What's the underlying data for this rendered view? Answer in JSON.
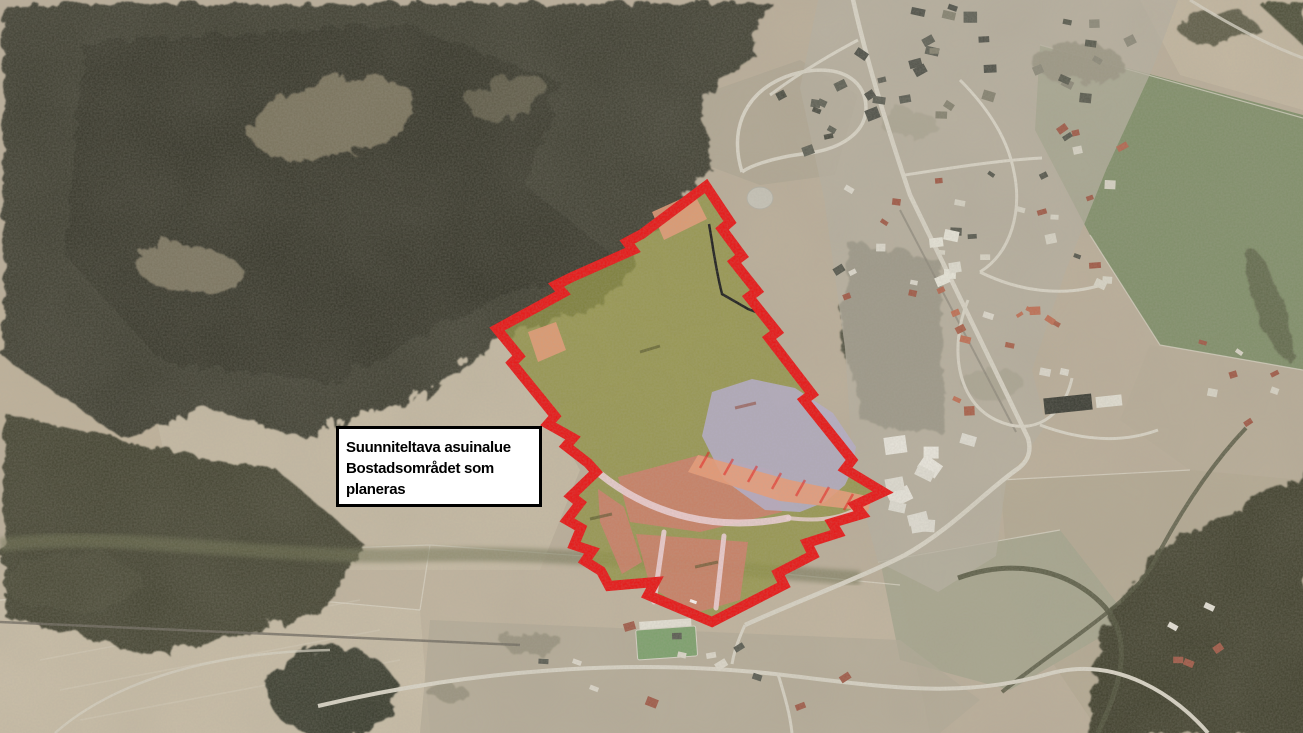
{
  "map_label": {
    "line_fi": "Suunniteltava asuinalue",
    "line_sv": "Bostadsområdet som planeras"
  },
  "overlay": {
    "zones": [
      {
        "name": "planning-area-boundary",
        "color": "#e81313"
      },
      {
        "name": "green-area",
        "color": "#8f9140"
      },
      {
        "name": "residential-blocks",
        "color": "#e99b77"
      },
      {
        "name": "residential-blocks-south",
        "color": "#d07d68"
      },
      {
        "name": "special-area",
        "color": "#b5adc6"
      },
      {
        "name": "internal-streets",
        "color": "#eed2d6"
      },
      {
        "name": "footpath",
        "color": "#1a1a1a"
      }
    ]
  }
}
